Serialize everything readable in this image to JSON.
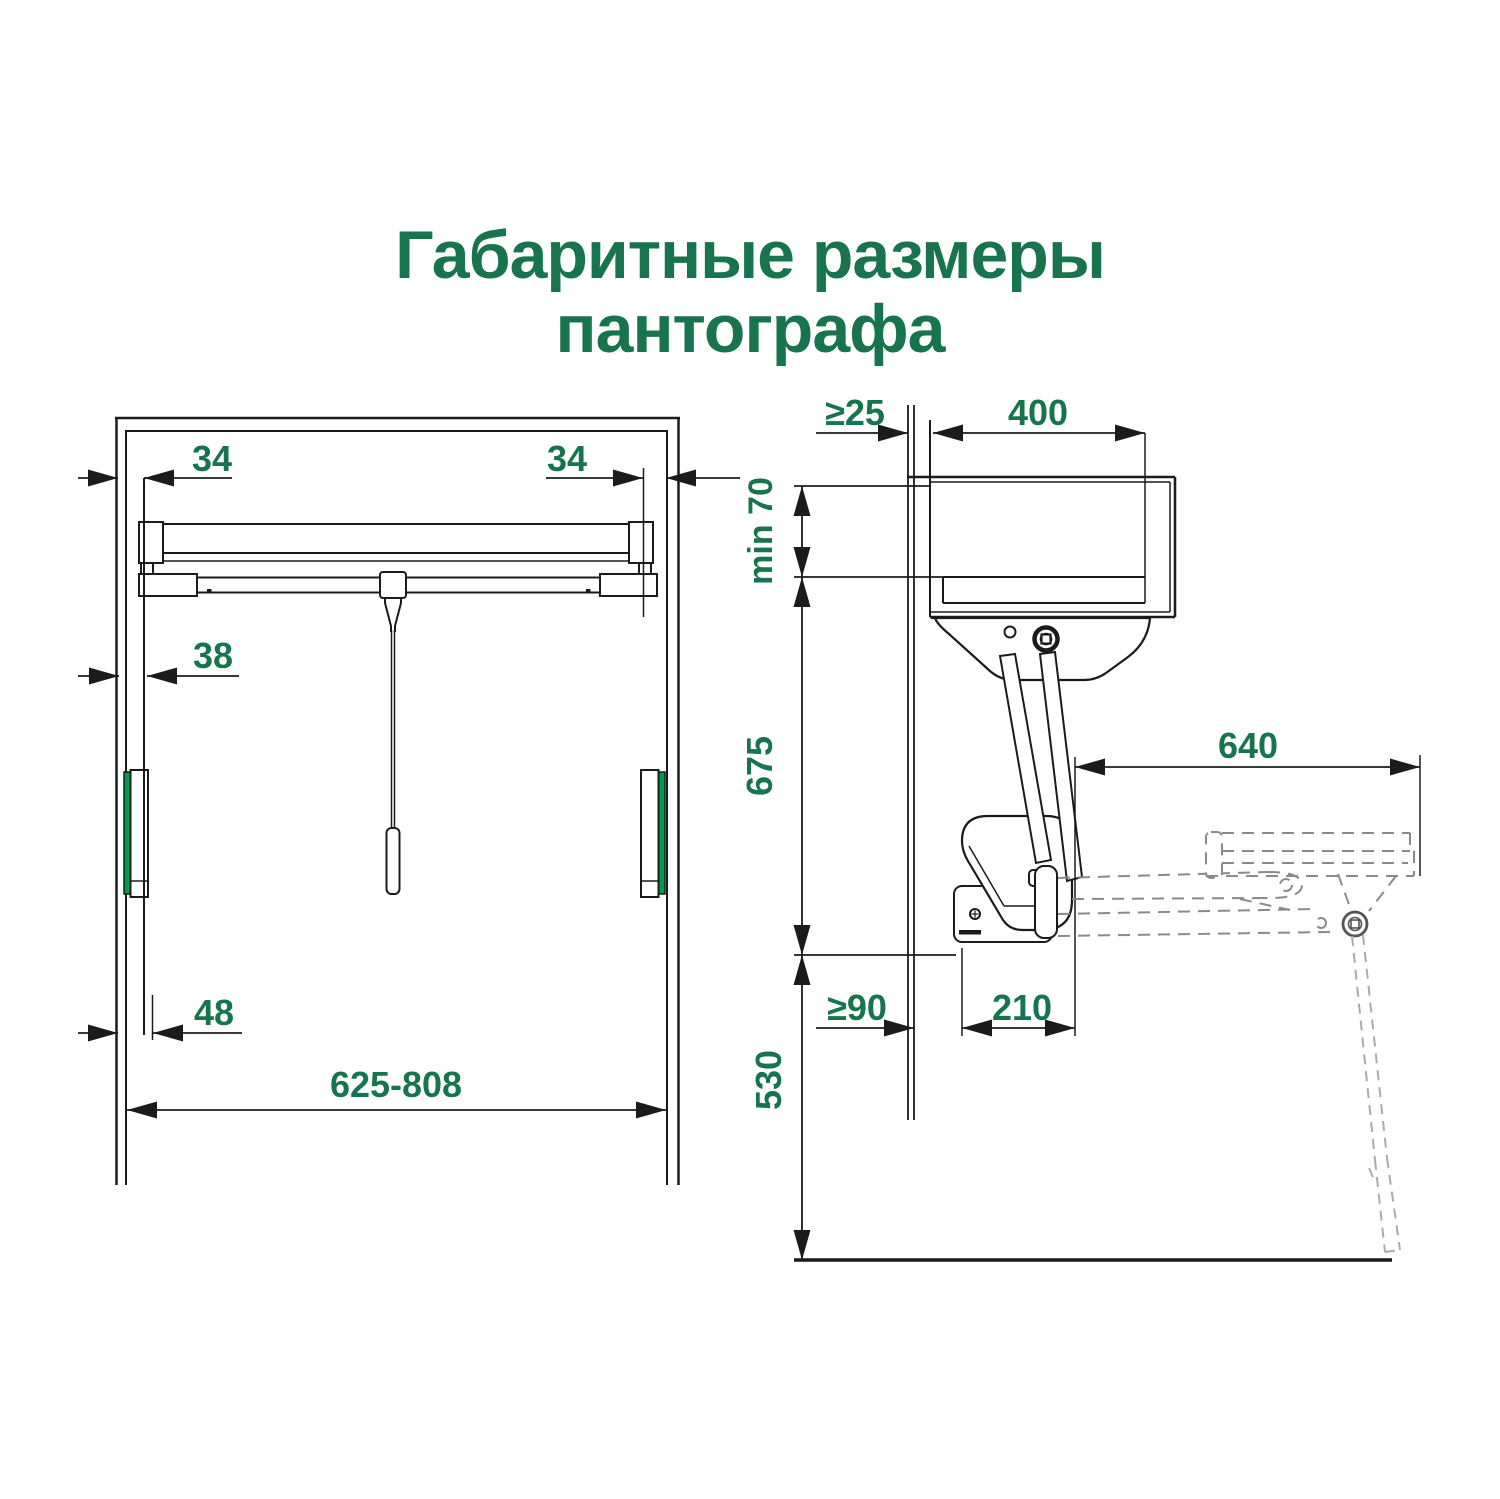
{
  "title": {
    "line1": "Габаритные размеры",
    "line2": "пантографа"
  },
  "colors": {
    "text_green": "#17744e",
    "strip_green": "#009b4f"
  },
  "front_view": {
    "dims": {
      "left_offset": "34",
      "right_offset": "34",
      "rail_offset": "38",
      "bottom_offset": "48",
      "width_range": "625-808"
    }
  },
  "side_view": {
    "dims": {
      "back_gap": "≥25",
      "top_depth": "400",
      "top_clearance": "min 70",
      "height_closed": "675",
      "extension": "640",
      "wall_clearance": "≥90",
      "unit_depth": "210",
      "drop": "530"
    }
  }
}
